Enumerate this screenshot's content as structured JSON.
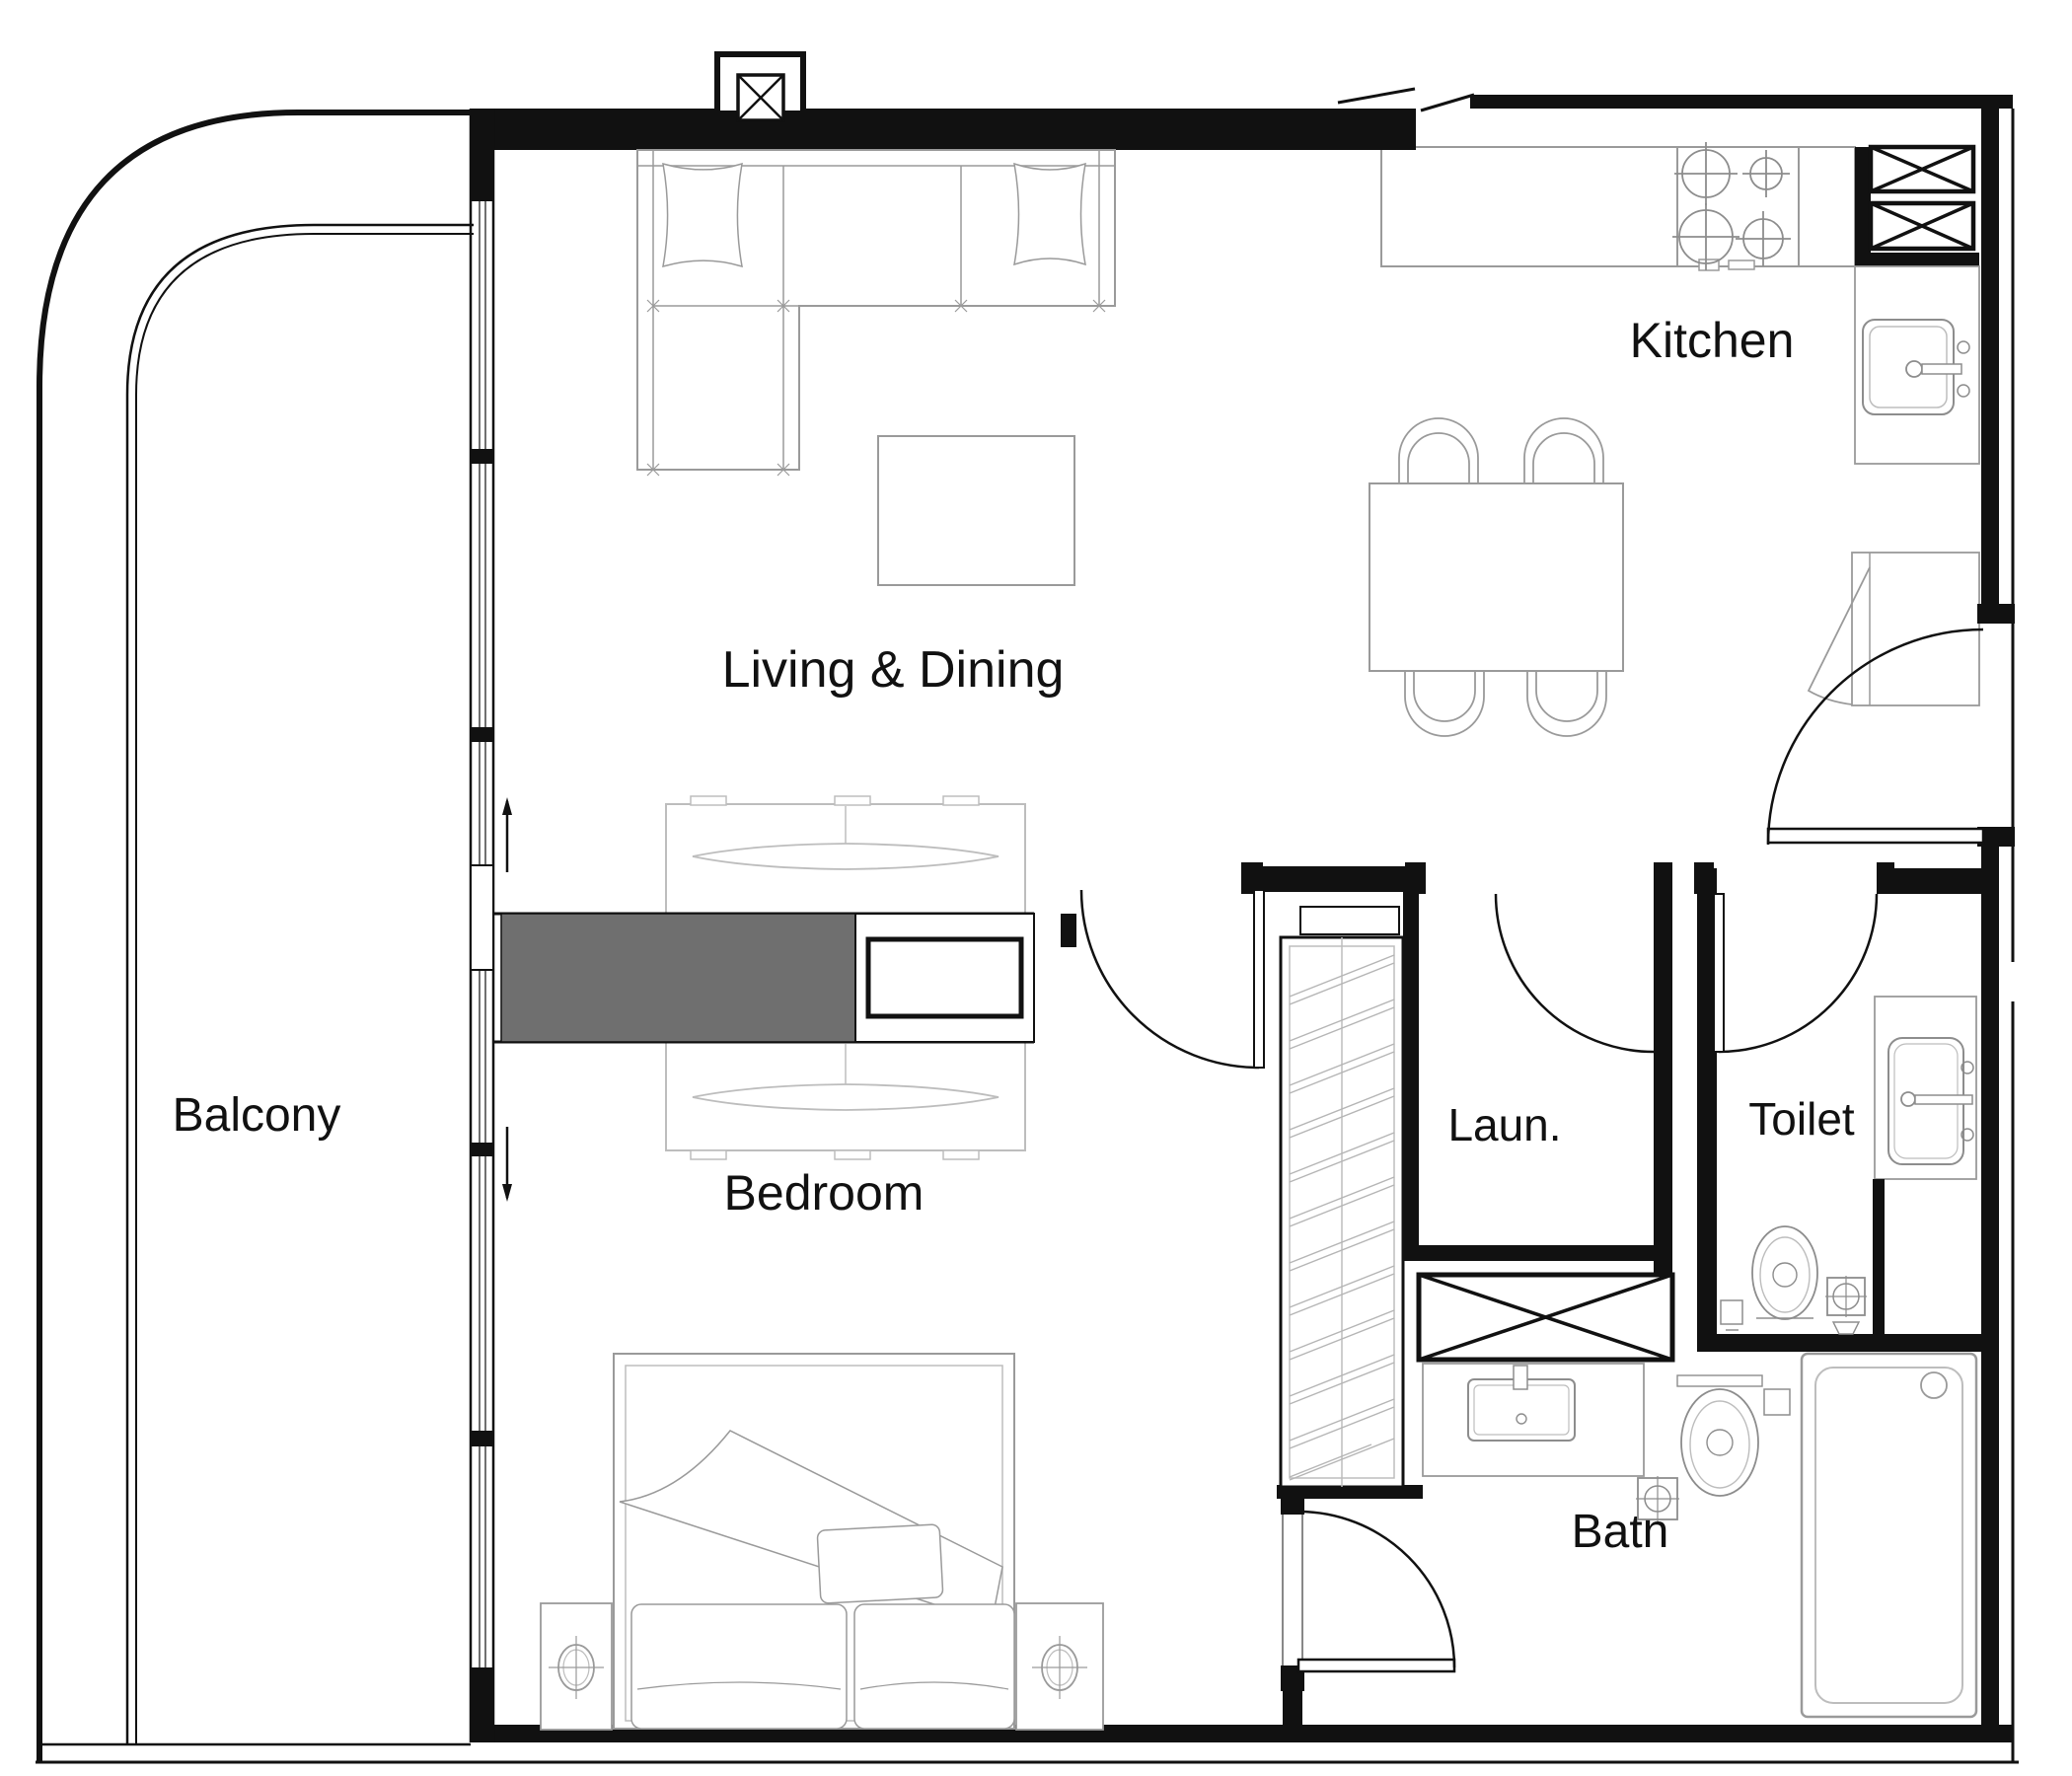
{
  "title": "Apartment unit floor plan - 1 bedroom",
  "labels": {
    "balcony": "Balcony",
    "living_dining": "Living & Dining",
    "kitchen": "Kitchen",
    "bedroom": "Bedroom",
    "laundry": "Laun.",
    "toilet": "Toilet",
    "bath": "Bath"
  },
  "rooms": [
    {
      "name": "Balcony"
    },
    {
      "name": "Living & Dining"
    },
    {
      "name": "Kitchen"
    },
    {
      "name": "Bedroom"
    },
    {
      "name": "Laun."
    },
    {
      "name": "Toilet"
    },
    {
      "name": "Bath"
    }
  ],
  "symbols": {
    "shaft": "box with X cross",
    "door": "quarter-circle swing arc with leaf",
    "window_wall": "double line glazing with mullions",
    "stove": "four burner circles with cross ticks",
    "closet": "double diagonal hatch strip",
    "wardrobe": "solid gray block"
  },
  "colors": {
    "wall": "#111111",
    "furniture": "#9a9a9a",
    "light": "#bdbdbd",
    "fixture": "#8d8d8d",
    "hatch": "#b5b5b5",
    "wardrobe": "#6f6f6f",
    "background": "#ffffff"
  }
}
